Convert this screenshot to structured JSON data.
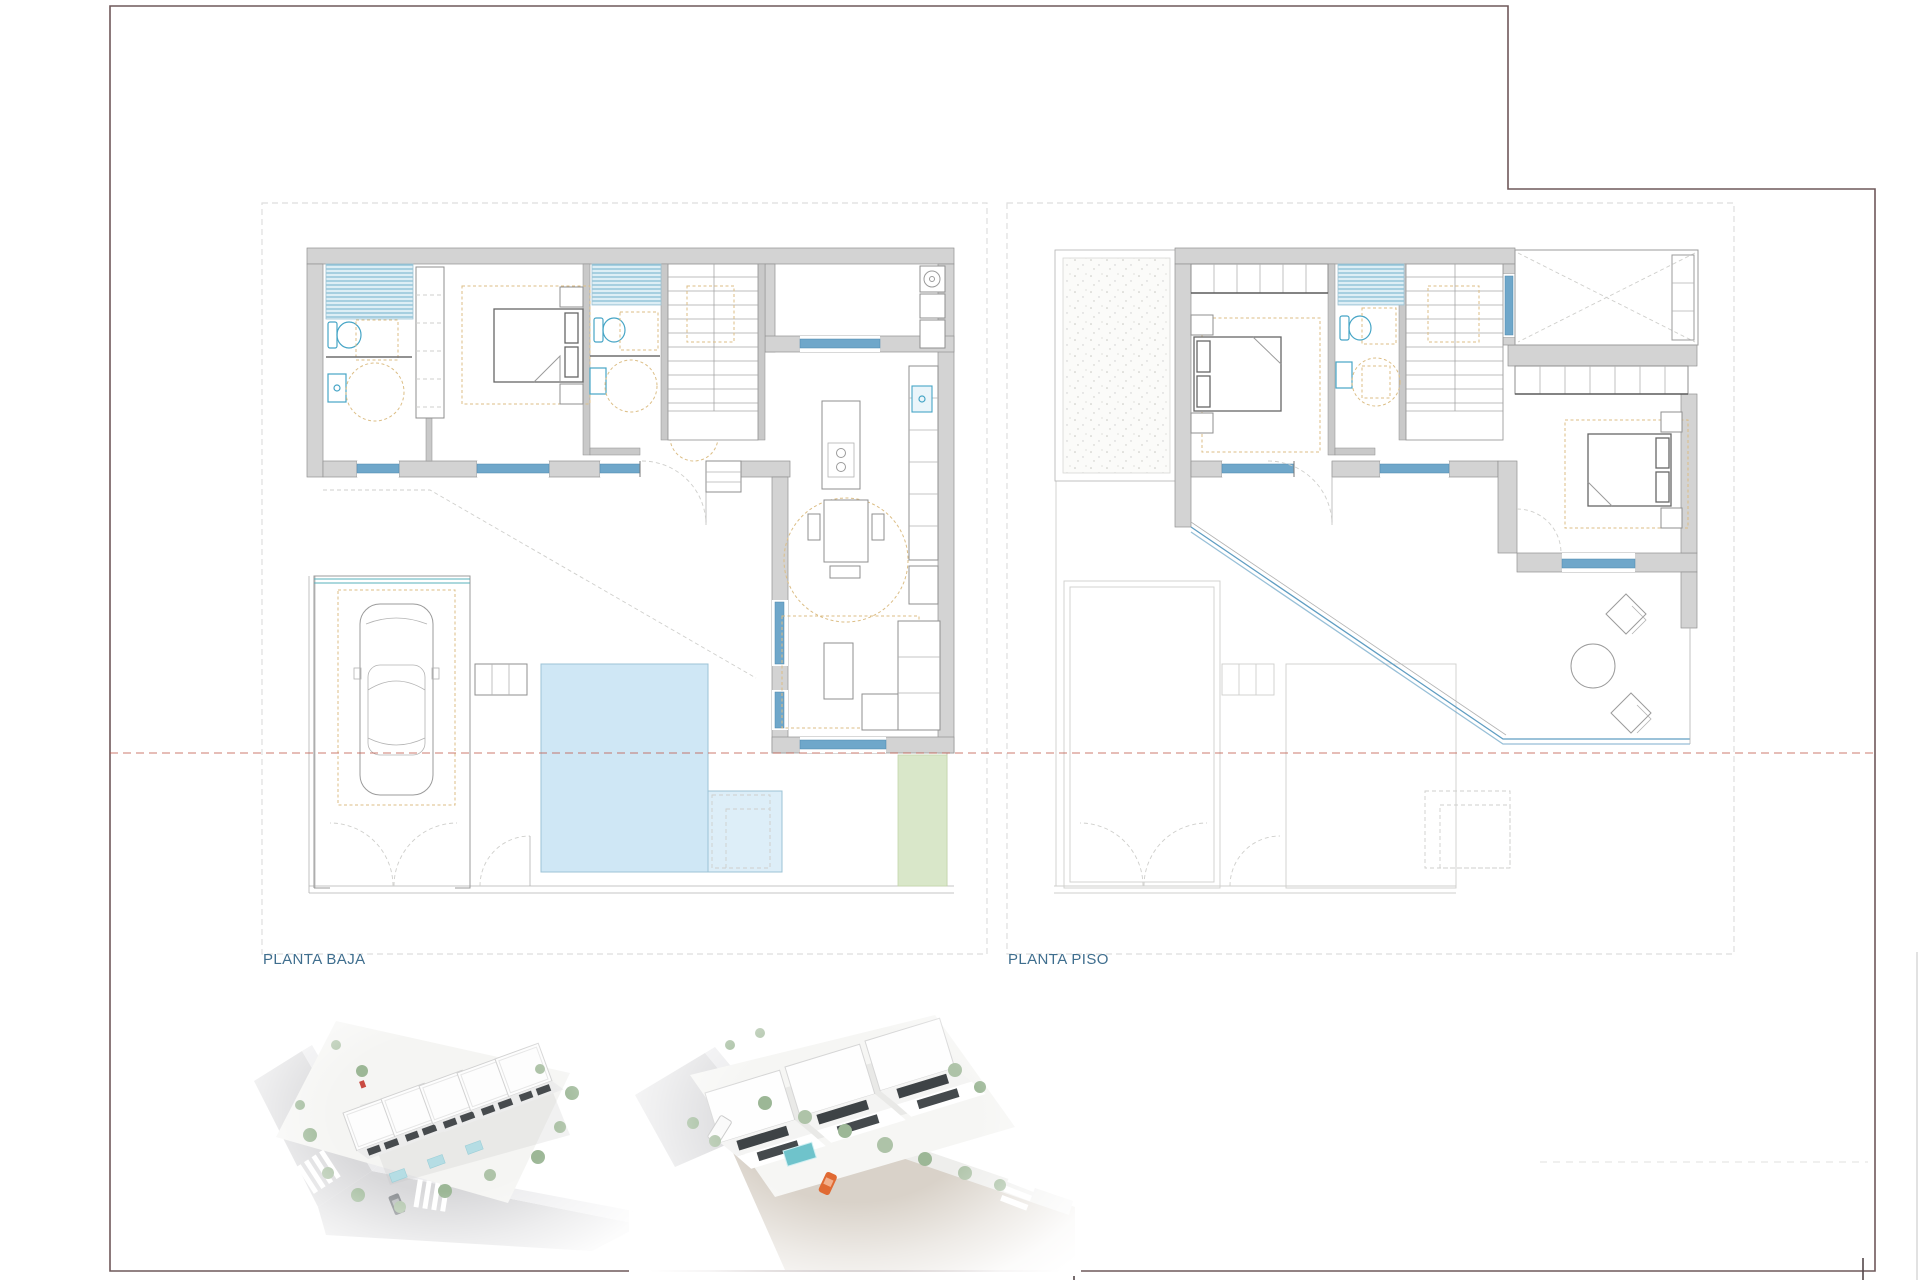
{
  "sheet": {
    "background": "#ffffff",
    "border_color": "#6f585a"
  },
  "plans": {
    "ground_floor": {
      "label": "PLANTA BAJA"
    },
    "upper_floor": {
      "label": "PLANTA PISO"
    }
  },
  "palette": {
    "wall_gray": "#d3d3d3",
    "window_blue": "#6fa7ca",
    "fixture_teal": "#46a5c6",
    "shower_stripe_blue": "#79b6ce",
    "rug_tan": "#dcbe86",
    "pool_blue": "#cfe7f5",
    "lawn_green": "#d9e7c9",
    "plot_boundary_red": "#bf5a4b",
    "label_blue": "#3f6e8e",
    "render_street_gray": "#d9d9db",
    "render_road_tan": "#d9d2c9",
    "render_tree_green": "#9cb796",
    "render_pool_teal": "#6fc3cb",
    "render_car_orange": "#e06a33"
  }
}
